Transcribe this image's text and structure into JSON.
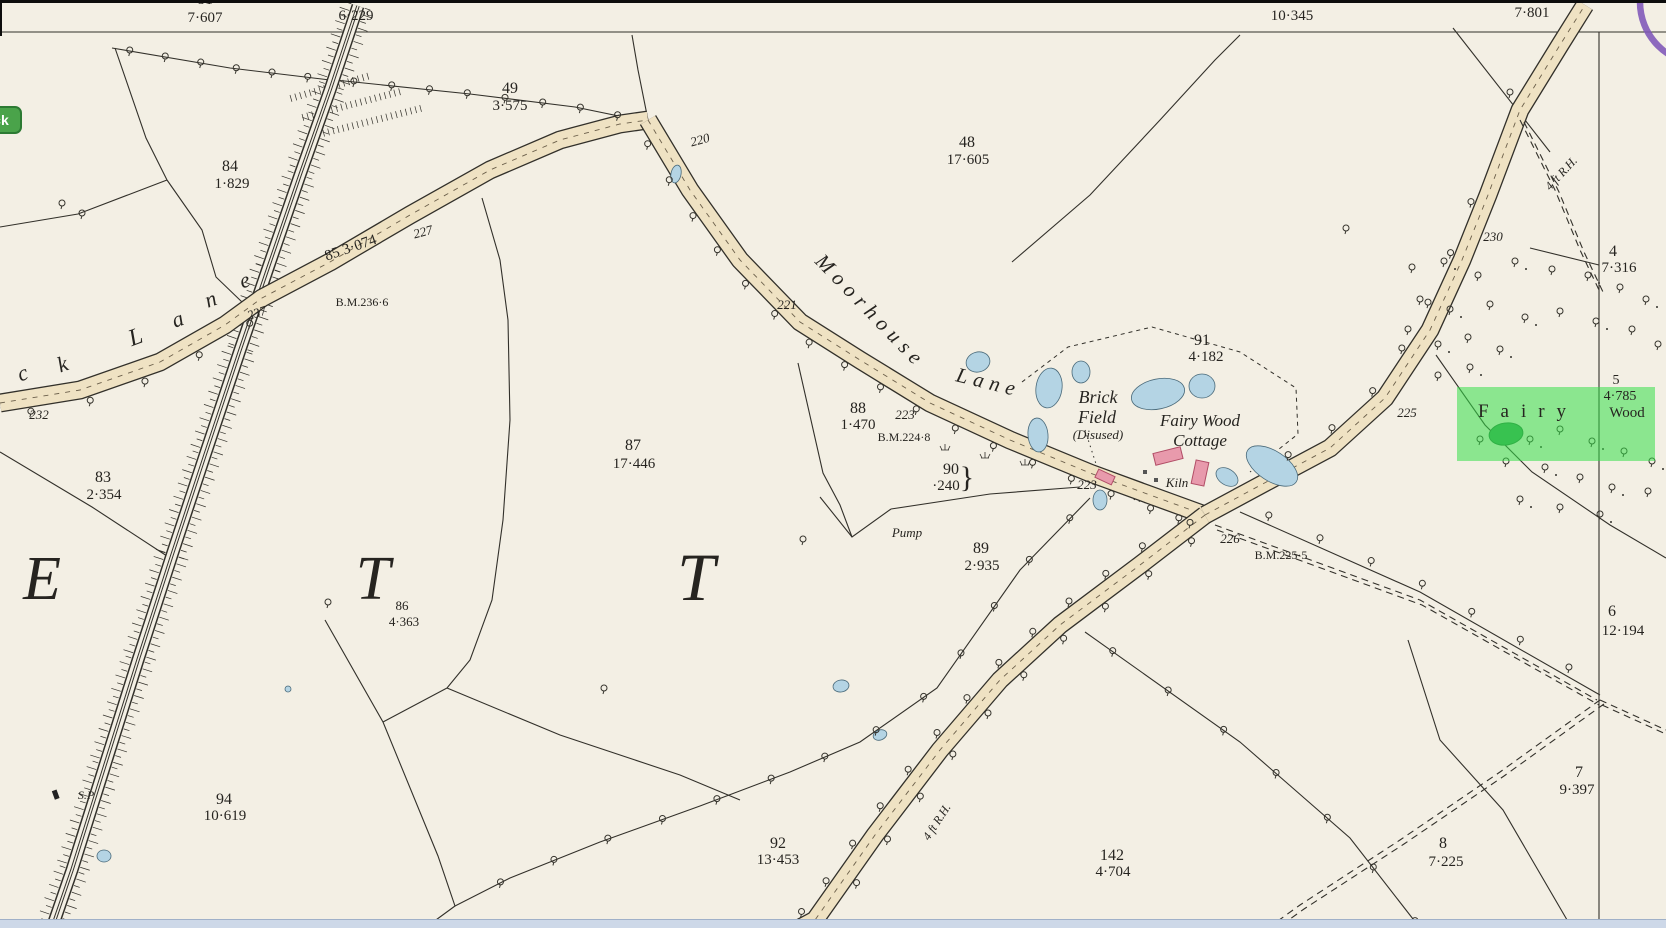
{
  "ui": {
    "back_button": {
      "label": "Back",
      "color": "#4aa34a"
    },
    "highlight": {
      "target": "Fairy Wood",
      "color": "#35df49"
    },
    "annotation_circle_color": "#7e57b8",
    "scrollbar_color": "#cdd8e8"
  },
  "map": {
    "style_colors": {
      "paper": "#f3efe4",
      "ink": "#32302a",
      "road_fill": "#efe2c3",
      "water": "#b4d4e4",
      "building": "#e89aac",
      "highlight_green": "#35df49"
    },
    "texts": [
      {
        "t": "81",
        "x": 205,
        "y": 4,
        "s": 16
      },
      {
        "t": "7·607",
        "x": 205,
        "y": 22,
        "s": 15
      },
      {
        "t": "98",
        "x": 356,
        "y": 2,
        "s": 16
      },
      {
        "t": "6·229",
        "x": 356,
        "y": 20,
        "s": 15
      },
      {
        "t": "10·345",
        "x": 1292,
        "y": 20,
        "s": 15
      },
      {
        "t": "7·801",
        "x": 1532,
        "y": 17,
        "s": 15
      },
      {
        "t": "49",
        "x": 510,
        "y": 93,
        "s": 16
      },
      {
        "t": "3·575",
        "x": 510,
        "y": 110,
        "s": 15
      },
      {
        "t": "48",
        "x": 967,
        "y": 147,
        "s": 16
      },
      {
        "t": "17·605",
        "x": 968,
        "y": 164,
        "s": 15
      },
      {
        "t": "84",
        "x": 230,
        "y": 171,
        "s": 16
      },
      {
        "t": "1·829",
        "x": 232,
        "y": 188,
        "s": 15
      },
      {
        "t": "91",
        "x": 1202,
        "y": 345,
        "s": 16
      },
      {
        "t": "4·182",
        "x": 1206,
        "y": 361,
        "s": 15
      },
      {
        "t": "88",
        "x": 858,
        "y": 413,
        "s": 16
      },
      {
        "t": "1·470",
        "x": 858,
        "y": 429,
        "s": 15
      },
      {
        "t": "87",
        "x": 633,
        "y": 450,
        "s": 16
      },
      {
        "t": "17·446",
        "x": 634,
        "y": 468,
        "s": 15
      },
      {
        "t": "83",
        "x": 103,
        "y": 482,
        "s": 16
      },
      {
        "t": "2·354",
        "x": 104,
        "y": 499,
        "s": 15
      },
      {
        "t": "90",
        "x": 951,
        "y": 474,
        "s": 16
      },
      {
        "t": "·240",
        "x": 946,
        "y": 490,
        "s": 15
      },
      {
        "t": "}",
        "x": 967,
        "y": 487,
        "s": 30
      },
      {
        "t": "89",
        "x": 981,
        "y": 553,
        "s": 16
      },
      {
        "t": "2·935",
        "x": 982,
        "y": 570,
        "s": 15
      },
      {
        "t": "86",
        "x": 402,
        "y": 610,
        "s": 13
      },
      {
        "t": "4·363",
        "x": 404,
        "y": 626,
        "s": 13
      },
      {
        "t": "94",
        "x": 224,
        "y": 804,
        "s": 16
      },
      {
        "t": "10·619",
        "x": 225,
        "y": 820,
        "s": 15
      },
      {
        "t": "92",
        "x": 778,
        "y": 848,
        "s": 16
      },
      {
        "t": "13·453",
        "x": 778,
        "y": 864,
        "s": 15
      },
      {
        "t": "142",
        "x": 1112,
        "y": 860,
        "s": 16
      },
      {
        "t": "4·704",
        "x": 1113,
        "y": 876,
        "s": 15
      },
      {
        "t": "4",
        "x": 1613,
        "y": 256,
        "s": 16
      },
      {
        "t": "7·316",
        "x": 1619,
        "y": 272,
        "s": 15
      },
      {
        "t": "5",
        "x": 1616,
        "y": 384,
        "s": 14
      },
      {
        "t": "4·785",
        "x": 1620,
        "y": 400,
        "s": 14
      },
      {
        "t": "Wood",
        "x": 1627,
        "y": 417,
        "s": 15
      },
      {
        "t": "6",
        "x": 1612,
        "y": 616,
        "s": 16
      },
      {
        "t": "12·194",
        "x": 1623,
        "y": 635,
        "s": 15
      },
      {
        "t": "7",
        "x": 1579,
        "y": 777,
        "s": 16
      },
      {
        "t": "9·397",
        "x": 1577,
        "y": 794,
        "s": 15
      },
      {
        "t": "8",
        "x": 1443,
        "y": 848,
        "s": 16
      },
      {
        "t": "7·225",
        "x": 1446,
        "y": 866,
        "s": 15
      },
      {
        "t": "227",
        "x": 424,
        "y": 236,
        "s": 13,
        "i": 1,
        "r": -15
      },
      {
        "t": "220",
        "x": 701,
        "y": 144,
        "s": 13,
        "i": 1,
        "r": -15
      },
      {
        "t": "221",
        "x": 787,
        "y": 309,
        "s": 13,
        "i": 1
      },
      {
        "t": "237",
        "x": 258,
        "y": 317,
        "s": 13,
        "i": 1,
        "r": -18
      },
      {
        "t": "232",
        "x": 39,
        "y": 419,
        "s": 13,
        "i": 1
      },
      {
        "t": "223",
        "x": 905,
        "y": 419,
        "s": 13,
        "i": 1
      },
      {
        "t": "223",
        "x": 1087,
        "y": 489,
        "s": 13,
        "i": 1
      },
      {
        "t": "225",
        "x": 1407,
        "y": 417,
        "s": 13,
        "i": 1
      },
      {
        "t": "226",
        "x": 1230,
        "y": 543,
        "s": 13,
        "i": 1
      },
      {
        "t": "230",
        "x": 1493,
        "y": 241,
        "s": 13,
        "i": 1
      },
      {
        "t": "B.M.236·6",
        "x": 362,
        "y": 306,
        "s": 12
      },
      {
        "t": "B.M.224·8",
        "x": 904,
        "y": 441,
        "s": 12
      },
      {
        "t": "B.M.225·5",
        "x": 1281,
        "y": 559,
        "s": 12
      },
      {
        "t": "85  3·074",
        "x": 352,
        "y": 252,
        "s": 15,
        "r": -19
      },
      {
        "t": "Moorhouse",
        "x": 866,
        "y": 316,
        "s": 21,
        "i": 1,
        "r": 46,
        "ls": 6
      },
      {
        "t": "Lane",
        "x": 987,
        "y": 389,
        "s": 21,
        "i": 1,
        "r": 14,
        "ls": 6
      },
      {
        "t": "c",
        "x": 25,
        "y": 380,
        "s": 22,
        "i": 1,
        "r": -20
      },
      {
        "t": "k",
        "x": 65,
        "y": 371,
        "s": 22,
        "i": 1,
        "r": -20
      },
      {
        "t": "L",
        "x": 138,
        "y": 344,
        "s": 24,
        "i": 1,
        "r": -20
      },
      {
        "t": "a",
        "x": 180,
        "y": 326,
        "s": 22,
        "i": 1,
        "r": -20
      },
      {
        "t": "n",
        "x": 213,
        "y": 306,
        "s": 22,
        "i": 1,
        "r": -20
      },
      {
        "t": "e",
        "x": 247,
        "y": 287,
        "s": 22,
        "i": 1,
        "r": -20
      },
      {
        "t": "4 ft R.H.",
        "x": 940,
        "y": 824,
        "s": 12,
        "i": 1,
        "r": -57
      },
      {
        "t": "4 ft R.H.",
        "x": 1564,
        "y": 176,
        "s": 12,
        "i": 1,
        "r": -47
      },
      {
        "t": "S.P",
        "x": 86,
        "y": 799,
        "s": 12,
        "i": 1
      },
      {
        "t": "Pump",
        "x": 907,
        "y": 537,
        "s": 13,
        "i": 1
      },
      {
        "t": "Brick",
        "x": 1098,
        "y": 403,
        "s": 18,
        "i": 1
      },
      {
        "t": "Field",
        "x": 1097,
        "y": 423,
        "s": 18,
        "i": 1
      },
      {
        "t": "(Disused)",
        "x": 1098,
        "y": 439,
        "s": 13,
        "i": 1
      },
      {
        "t": "Fairy Wood",
        "x": 1200,
        "y": 426,
        "s": 17,
        "i": 1
      },
      {
        "t": "Cottage",
        "x": 1200,
        "y": 446,
        "s": 17,
        "i": 1
      },
      {
        "t": "Kiln",
        "x": 1177,
        "y": 487,
        "s": 13,
        "i": 1
      },
      {
        "t": "Fairy",
        "x": 1528,
        "y": 417,
        "s": 19,
        "ls": 12
      },
      {
        "t": "E",
        "x": 42,
        "y": 599,
        "s": 62,
        "i": 1
      },
      {
        "t": "T",
        "x": 373,
        "y": 599,
        "s": 62,
        "i": 1
      },
      {
        "t": "T",
        "x": 696,
        "y": 600,
        "s": 68,
        "i": 1
      }
    ]
  }
}
